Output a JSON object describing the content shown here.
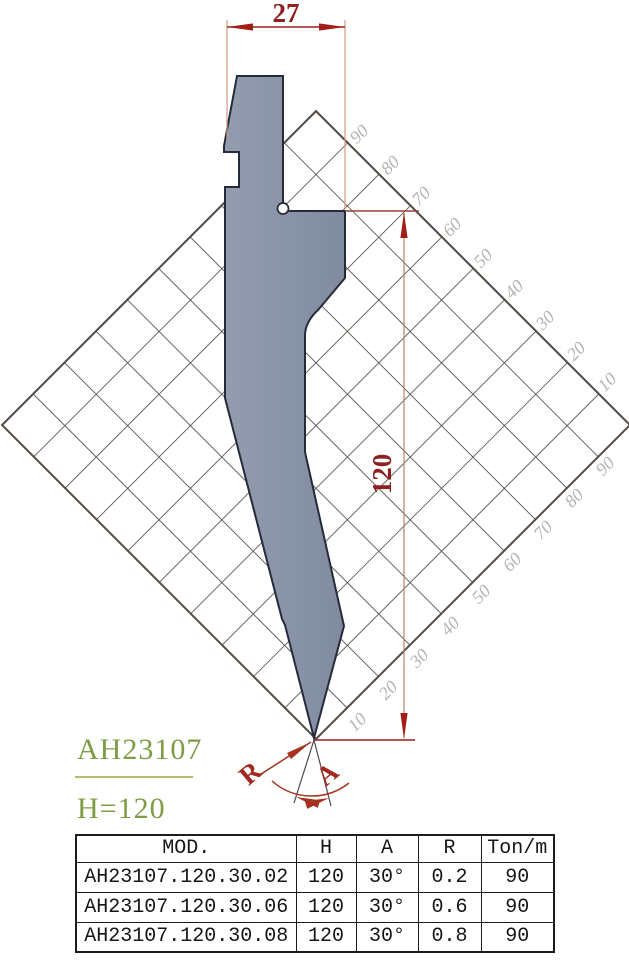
{
  "drawing": {
    "model": "AH23107",
    "height_label": "H=120",
    "width_dim": "27",
    "height_dim": "120",
    "radius_label": "R",
    "angle_label": "A"
  },
  "grid": {
    "ne_labels": [
      "90",
      "80",
      "70",
      "60",
      "50",
      "40",
      "30",
      "20",
      "10"
    ],
    "se_labels": [
      "10",
      "20",
      "30",
      "40",
      "50",
      "60",
      "70",
      "80",
      "90"
    ]
  },
  "table": {
    "headers": [
      "MOD.",
      "H",
      "A",
      "R",
      "Ton/m"
    ],
    "rows": [
      [
        "AH23107.120.30.02",
        "120",
        "30°",
        "0.2",
        "90"
      ],
      [
        "AH23107.120.30.06",
        "120",
        "30°",
        "0.6",
        "90"
      ],
      [
        "AH23107.120.30.08",
        "120",
        "30°",
        "0.8",
        "90"
      ]
    ]
  },
  "colors": {
    "punch_fill": "#8892a6",
    "punch_outline": "#252b3a",
    "grid_line": "#544d48",
    "grid_label": "#b5b2b0",
    "dimension_red": "#8e2020",
    "annotation_red": "#a3281f",
    "green_label": "#7d9c43"
  }
}
